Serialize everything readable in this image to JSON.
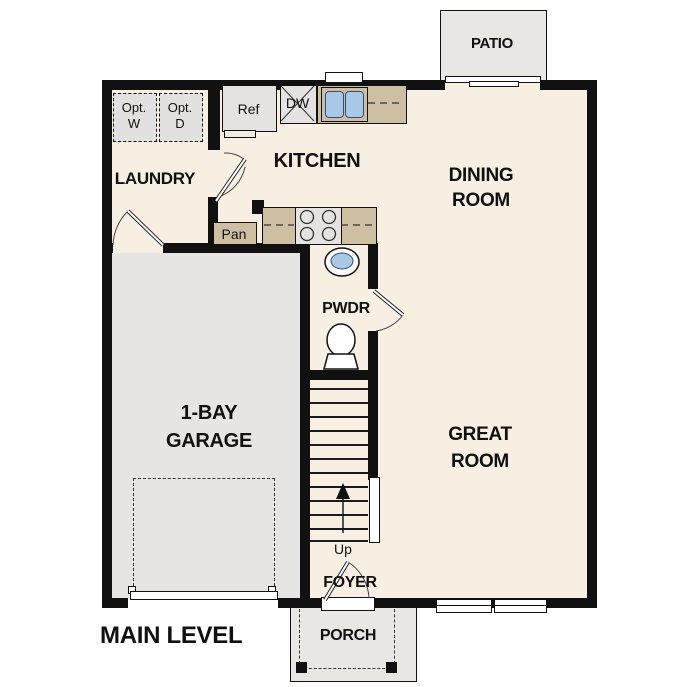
{
  "title": "MAIN LEVEL",
  "rooms": {
    "laundry": {
      "label": "LAUNDRY"
    },
    "kitchen": {
      "label": "KITCHEN"
    },
    "dining_room": {
      "line1": "DINING",
      "line2": "ROOM"
    },
    "great_room": {
      "line1": "GREAT",
      "line2": "ROOM"
    },
    "garage": {
      "line1": "1-BAY",
      "line2": "GARAGE"
    },
    "powder_room": {
      "label": "PWDR"
    },
    "foyer": {
      "label": "FOYER"
    },
    "porch": {
      "label": "PORCH"
    },
    "patio": {
      "label": "PATIO"
    }
  },
  "fixtures": {
    "refrigerator": {
      "label": "Ref"
    },
    "dishwasher": {
      "label": "DW"
    },
    "pantry": {
      "label": "Pan"
    },
    "stairs": {
      "direction_label": "Up"
    },
    "optional_washer": {
      "line1": "Opt.",
      "line2": "W"
    },
    "optional_dryer": {
      "line1": "Opt.",
      "line2": "D"
    }
  },
  "colors": {
    "wall": "#111111",
    "floor": "#f7efe2",
    "garage_floor": "#e6e5e3",
    "outdoor_concrete": "#e8e7e4",
    "counter": "#cdc0a2",
    "appliance": "#e4e3e1",
    "sink_basin": "#a9c7e7"
  }
}
